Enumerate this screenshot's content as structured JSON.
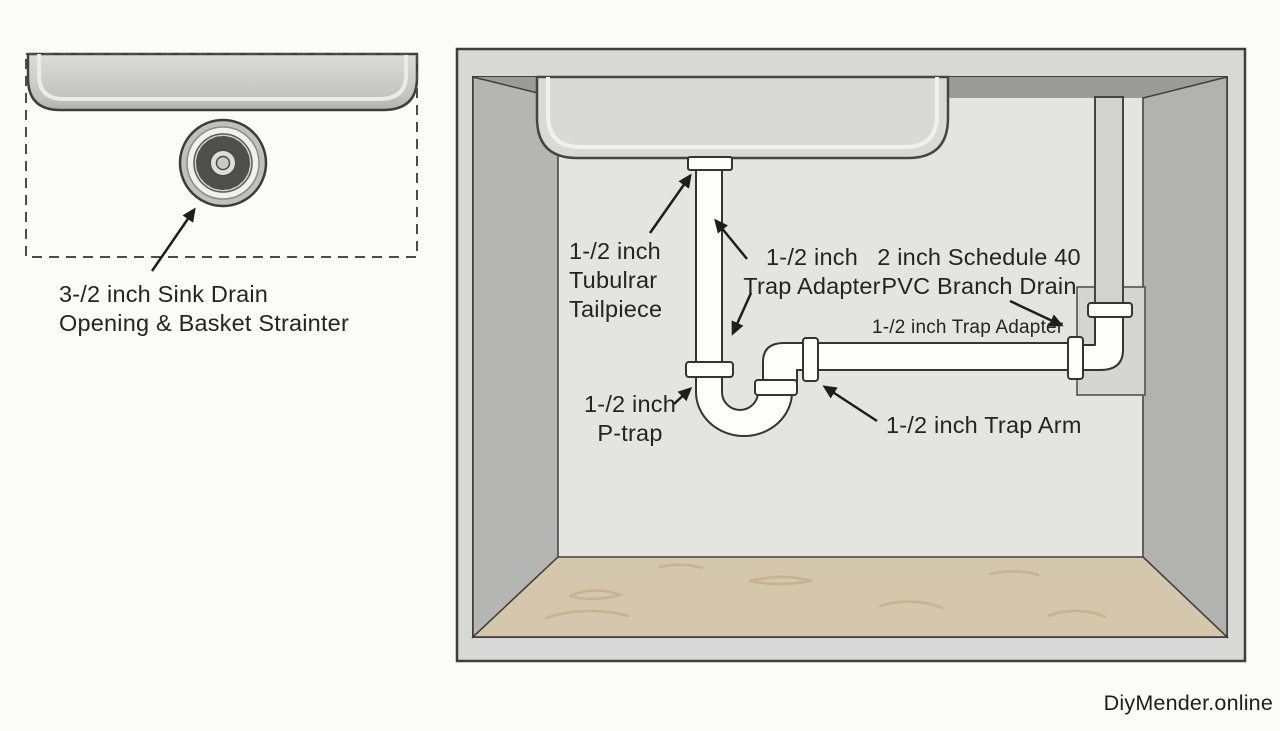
{
  "page": {
    "watermark": "DiyMender.online",
    "background_color": "#fbfbf9",
    "text_color": "#242424"
  },
  "inset_panel": {
    "description": "top view of sink bottom with basket strainer inside dashed outline",
    "caption_line1": "3-/2 inch Sink Drain",
    "caption_line2": "Opening & Basket Strainter"
  },
  "cabinet_diagram": {
    "description": "under-sink cabinet cutaway showing drain plumbing",
    "labels": {
      "tailpiece": {
        "l1": "1-/2 inch",
        "l2": "Tubulrar",
        "l3": "Tailpiece"
      },
      "trap_adapter_upper": {
        "l1": "1-/2 inch",
        "l2": "Trap Adapter"
      },
      "branch_drain": {
        "l1": "2 inch Schedule 40",
        "l2": "PVC Branch Drain"
      },
      "trap_adapter_lower": "1-/2 inch Trap Adapter",
      "p_trap": {
        "l1": "1-/2 inch",
        "l2": "P-trap"
      },
      "trap_arm": "1-/2 inch Trap Arm"
    },
    "colors": {
      "cabinet_frame": "#d8d8d6",
      "back_wall": "#e4e4e2",
      "top_shadow_band": "#9b9c99",
      "left_wall": "#b5b5b3",
      "right_wall": "#b2b2b0",
      "floor_wood": "#d5c7ab",
      "floor_grain": "#c5b394",
      "pipe_white": "#fdfdfc",
      "pipe_gray": "#d2d2d0",
      "sink_gray": "#d9d9d7",
      "outline": "#3c3c3a"
    }
  }
}
